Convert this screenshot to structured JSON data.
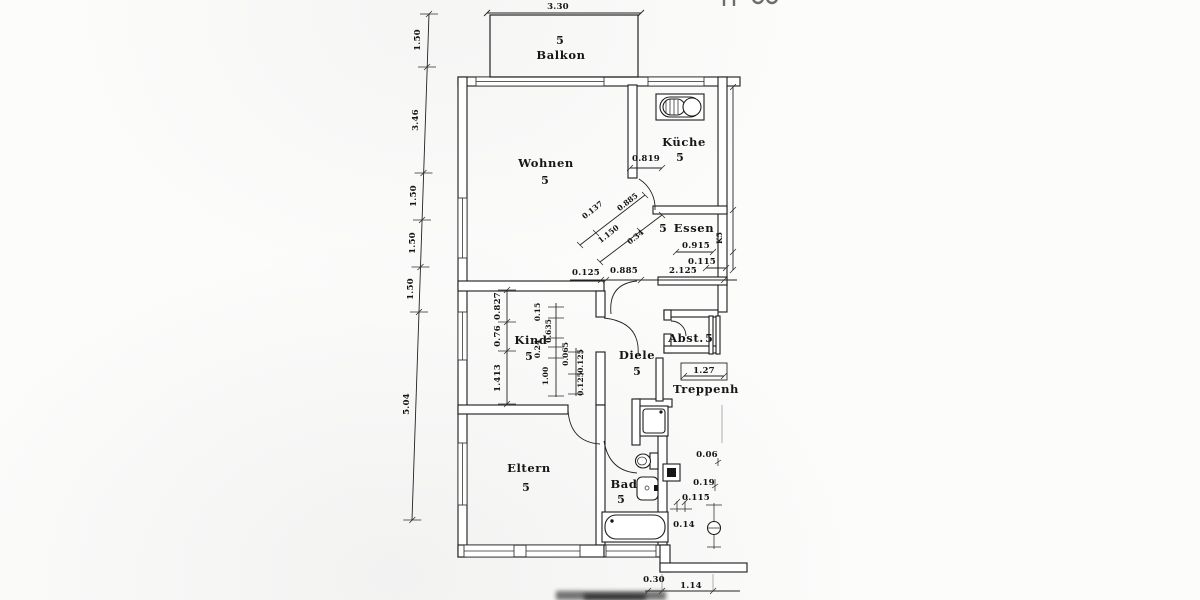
{
  "rooms": {
    "balkon": {
      "number": "5",
      "name": "Balkon"
    },
    "wohnen": {
      "number": "5",
      "name": "Wohnen"
    },
    "kueche": {
      "number": "5",
      "name": "Küche"
    },
    "essen": {
      "number": "5",
      "name": "Essen"
    },
    "kind": {
      "number": "5",
      "name": "Kind"
    },
    "diele": {
      "number": "5",
      "name": "Diele"
    },
    "abst": {
      "number": "5",
      "name": "Abst."
    },
    "eltern": {
      "number": "5",
      "name": "Eltern"
    },
    "bad": {
      "number": "5",
      "name": "Bad"
    },
    "treppenhaus": {
      "name": "Treppenh"
    }
  },
  "dims": {
    "balkon_width": "3.30",
    "left_chain": [
      "1.50",
      "3.46",
      "1.50",
      "1.50",
      "1.50",
      "5.04"
    ],
    "kueche_door": "0.819",
    "diag": [
      "0.137",
      "0.885",
      "1.150",
      "0.34"
    ],
    "mid": [
      "0.125",
      "0.885",
      "2.125"
    ],
    "essen": [
      "0.915",
      "0.115"
    ],
    "shaft_label": "K5",
    "kind_left": [
      "0.827",
      "0.76",
      "1.413"
    ],
    "kind_mid": [
      "0.15",
      "0.635",
      "0.24",
      "0.065",
      "1.00",
      "0.125",
      "0.125"
    ],
    "treppe_width": "1.27",
    "entry_right": [
      "0.06",
      "0.19",
      "0.115",
      "0.14"
    ],
    "bottom": [
      "0.30",
      "1.14"
    ]
  }
}
